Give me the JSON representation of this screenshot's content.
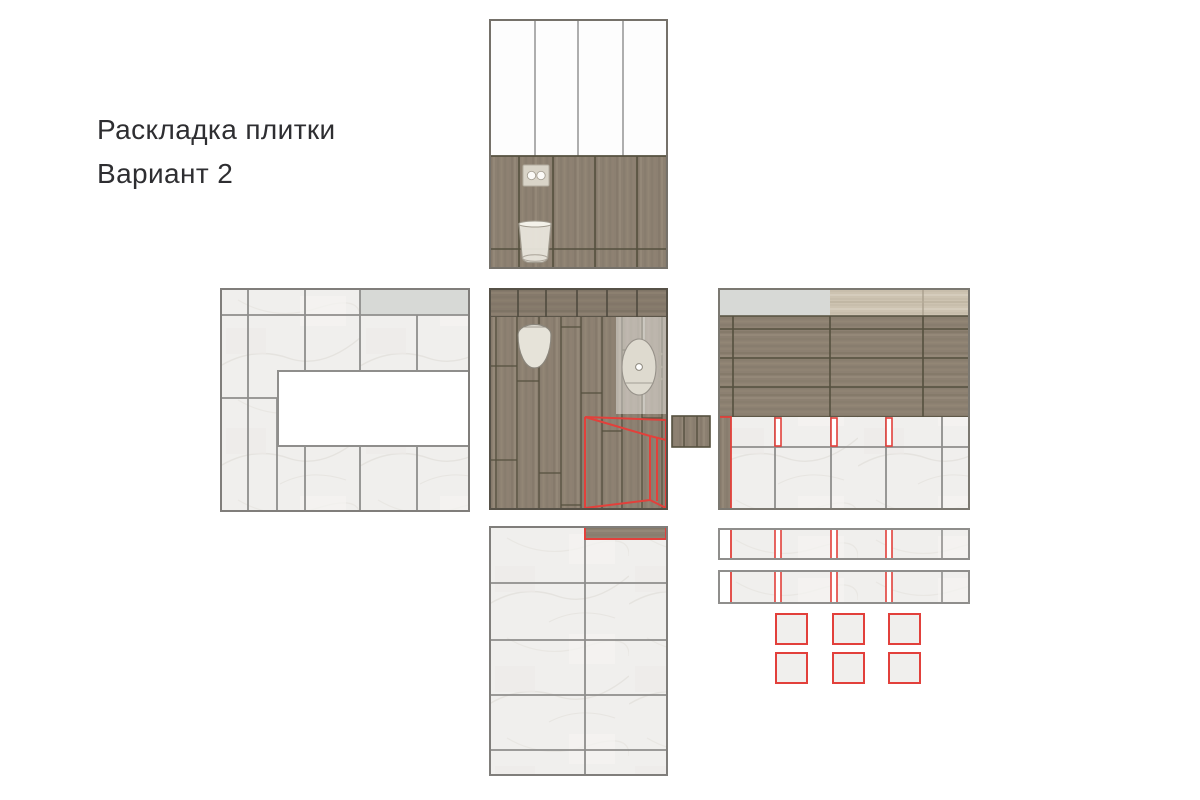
{
  "title": {
    "line1": "Раскладка плитки",
    "line2": "Вариант 2"
  },
  "colors": {
    "background": "#ffffff",
    "title_text": "#2e2e31",
    "tile_light": "#f0efed",
    "tile_grout": "#8f8e8c",
    "white_tile": "#fdfdfd",
    "wood_base": "#8c8071",
    "wood_joint": "#55503f",
    "wood_light_top": "#cdc3b1",
    "gray_accent_strip": "#d7d9d6",
    "highlight_red": "#e2403b",
    "niche_white": "#ffffff"
  },
  "panels": [
    {
      "id": "top-wall",
      "label": "wall elevation: white tiles over wood panels with flush plate and wall-hung toilet"
    },
    {
      "id": "left-wall",
      "label": "wall elevation: large light tiles with gray strip and white niche"
    },
    {
      "id": "center-plan",
      "label": "floor plan: wood planks, toilet, sink counter, red vanity highlight"
    },
    {
      "id": "right-wall",
      "label": "wall elevation: gray strip, horizontal wood planks, light tiles with red cut marks"
    },
    {
      "id": "floor-plan",
      "label": "floor layout: large light tiles, red-marked wood strip"
    },
    {
      "id": "cut-rows",
      "label": "two tile rows with red cut-strip marks"
    },
    {
      "id": "cut-squares",
      "label": "six small tiles outlined in red"
    }
  ]
}
